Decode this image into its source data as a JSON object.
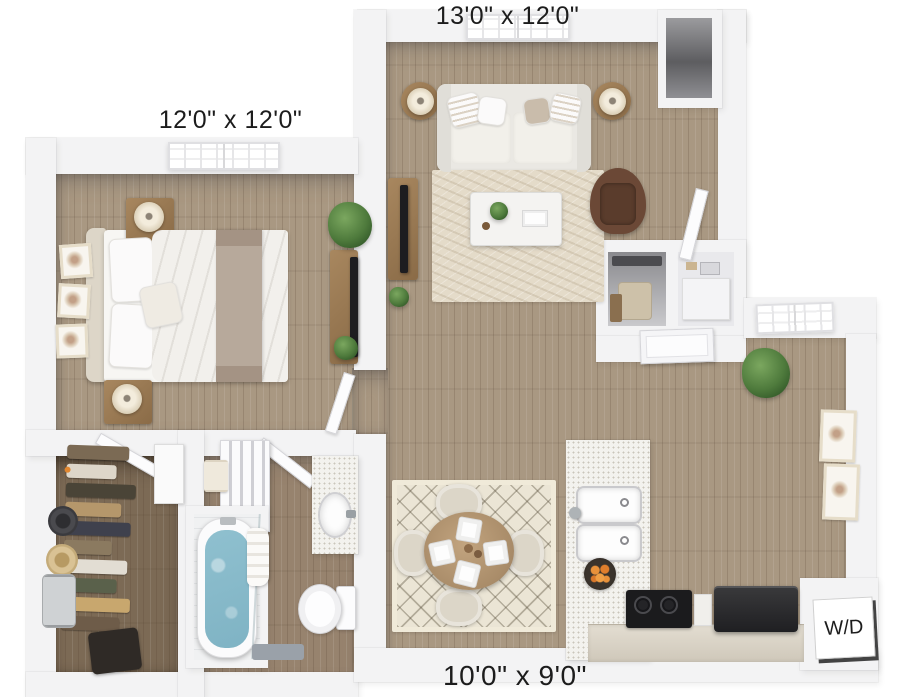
{
  "floorplan": {
    "labels": {
      "living_room_dims": "13'0\" x 12'0\"",
      "bedroom_dims": "12'0\" x 12'0\"",
      "kitchen_dims": "10'0\" x 9'0\"",
      "washer_dryer": "W/D"
    },
    "colors": {
      "background": "#ffffff",
      "wall": "#f3f3f4",
      "floor_wood": "#a99882",
      "floor_wood_mid": "#97836e",
      "floor_wood_dark": "#7c6a55",
      "rug_living": "#e4dbc9",
      "rug_dining": "#ebe5d5",
      "tub_water": "#7fb3c4",
      "accent_chair": "#6b4836",
      "label_text": "#1c1c1c"
    }
  }
}
